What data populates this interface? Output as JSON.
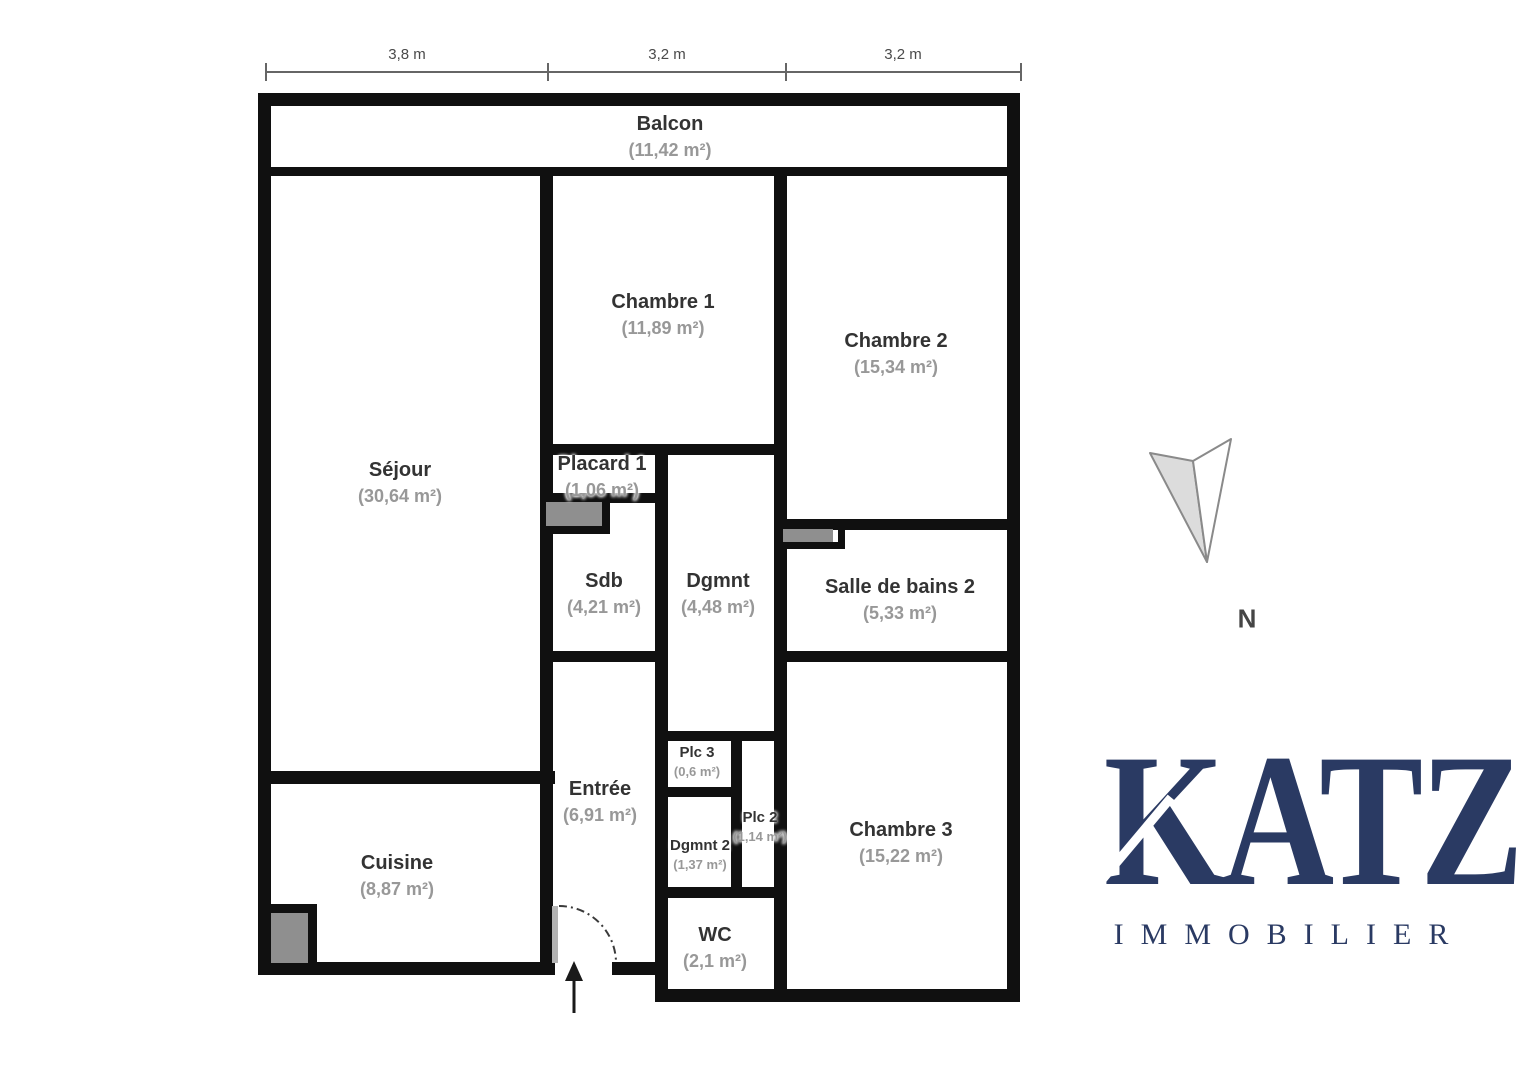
{
  "plan": {
    "dimension_labels": [
      "3,8 m",
      "3,2 m",
      "3,2 m"
    ],
    "north_label": "N",
    "rooms": {
      "balcon": {
        "name": "Balcon",
        "area": "(11,42 m²)"
      },
      "sejour": {
        "name": "Séjour",
        "area": "(30,64 m²)"
      },
      "chambre1": {
        "name": "Chambre 1",
        "area": "(11,89 m²)"
      },
      "chambre2": {
        "name": "Chambre 2",
        "area": "(15,34 m²)"
      },
      "placard1": {
        "name": "Placard 1",
        "area": "(1,06 m²)"
      },
      "sdb": {
        "name": "Sdb",
        "area": "(4,21 m²)"
      },
      "dgmnt": {
        "name": "Dgmnt",
        "area": "(4,48 m²)"
      },
      "sdb2": {
        "name": "Salle de bains 2",
        "area": "(5,33 m²)"
      },
      "entree": {
        "name": "Entrée",
        "area": "(6,91 m²)"
      },
      "plc3": {
        "name": "Plc 3",
        "area": "(0,6 m²)"
      },
      "plc2": {
        "name": "Plc 2",
        "area": "(1,14 m²)"
      },
      "dgmnt2": {
        "name": "Dgmnt 2",
        "area": "(1,37 m²)"
      },
      "chambre3": {
        "name": "Chambre 3",
        "area": "(15,22 m²)"
      },
      "cuisine": {
        "name": "Cuisine",
        "area": "(8,87 m²)"
      },
      "wc": {
        "name": "WC",
        "area": "(2,1 m²)"
      }
    }
  },
  "logo": {
    "brand": "KATZ",
    "subtitle": "IMMOBILIER",
    "color": "#2a3a63"
  },
  "colors": {
    "wall": "#101010",
    "fixture": "#8f8f8f",
    "room_name": "#333333",
    "room_area": "#989898"
  }
}
